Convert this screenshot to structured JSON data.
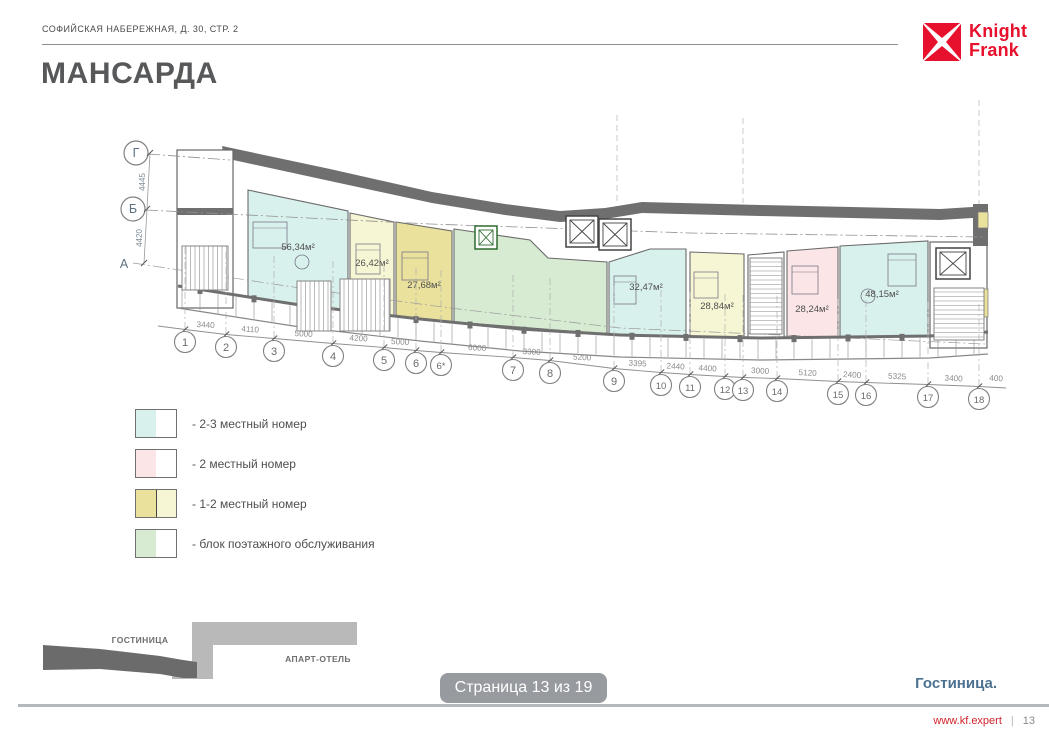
{
  "header": {
    "address": "СОФИЙСКАЯ НАБЕРЕЖНАЯ, Д. 30, СТР. 2",
    "logo": {
      "word1": "Knight",
      "word2": "Frank",
      "brand_color": "#e8112d"
    }
  },
  "title": "МАНСАРДА",
  "plan": {
    "axis_letters": [
      "Г",
      "Б",
      "А"
    ],
    "left_dimensions": [
      "4445",
      "4420"
    ],
    "grid_labels": [
      "1",
      "2",
      "3",
      "4",
      "5",
      "6",
      "6*",
      "7",
      "8",
      "9",
      "10",
      "11",
      "12",
      "13",
      "14",
      "15",
      "16",
      "17",
      "18"
    ],
    "dimensions": [
      "3440",
      "4110",
      "5000",
      "4200",
      "5000",
      "6000",
      "3300",
      "5200",
      "3395",
      "2440",
      "4400",
      "3000",
      "5120",
      "2400",
      "5325",
      "3400",
      "400"
    ],
    "rooms": [
      {
        "name": "room-2-3-bed-left",
        "area": "56,34м²",
        "color": "#d9f1ed"
      },
      {
        "name": "room-1-2-bed-a",
        "area": "26,42м²",
        "color": "#f7f6d4"
      },
      {
        "name": "room-1-2-bed-b",
        "area": "27,68м²",
        "color": "#e9e19c"
      },
      {
        "name": "service-block",
        "area": "",
        "color": "#d7ebd3"
      },
      {
        "name": "room-2-3-bed-mid",
        "area": "32,47м²",
        "color": "#d9f1ed"
      },
      {
        "name": "room-1-2-bed-c",
        "area": "28,84м²",
        "color": "#f7f6d4"
      },
      {
        "name": "room-2-bed",
        "area": "28,24м²",
        "color": "#fbe5e6"
      },
      {
        "name": "room-2-3-bed-right",
        "area": "48,15м²",
        "color": "#d9f1ed"
      }
    ]
  },
  "legend": {
    "items": [
      {
        "label": "- 2-3 местный номер",
        "color": "#d9f1ed",
        "color2": ""
      },
      {
        "label": "- 2 местный номер",
        "color": "#fbe5e6",
        "color2": ""
      },
      {
        "label": "- 1-2 местный номер",
        "color": "#e9e19c",
        "color2": "#f7f6d4"
      },
      {
        "label": "- блок поэтажного обслуживания",
        "color": "#d7ebd3",
        "color2": ""
      }
    ]
  },
  "minimap": {
    "hotel_label": "ГОСТИНИЦА",
    "apart_label": "АПАРТ-ОТЕЛЬ"
  },
  "page_badge": {
    "label": "Страница 13 из 19"
  },
  "footer": {
    "section_label": "Гостиница.",
    "url": "www.kf.expert",
    "separator": "|",
    "page_number": "13"
  }
}
